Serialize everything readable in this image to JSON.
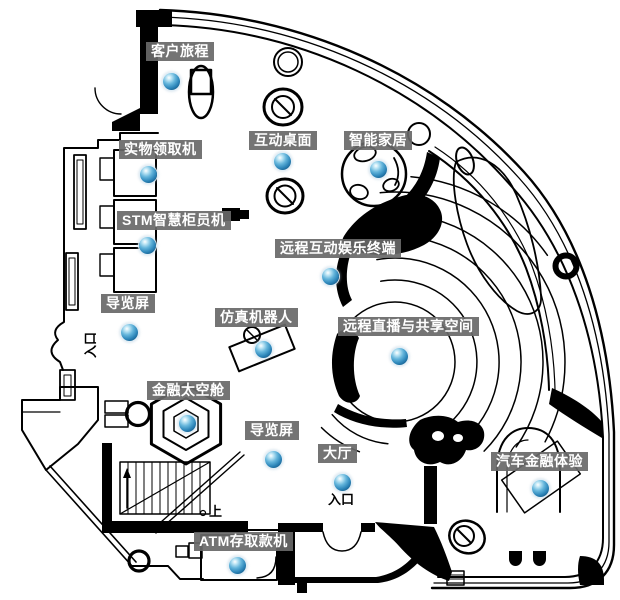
{
  "map": {
    "colors": {
      "background": "#ffffff",
      "wall": "#000000",
      "label_bg": "#686868",
      "label_text": "#ffffff",
      "hotspot_blue": "#2f88bb"
    },
    "pois": [
      {
        "id": "customer-journey",
        "label": "客户旅程",
        "label_x": 146,
        "label_y": 42,
        "dot_x": 171,
        "dot_y": 81
      },
      {
        "id": "physical-item-pickup-machine",
        "label": "实物领取机",
        "label_x": 119,
        "label_y": 140,
        "dot_x": 148,
        "dot_y": 174
      },
      {
        "id": "stm-smart-teller-machine",
        "label": "STM智慧柜员机",
        "label_x": 117,
        "label_y": 211,
        "dot_x": 147,
        "dot_y": 245
      },
      {
        "id": "guide-screen-north",
        "label": "导览屏",
        "label_x": 101,
        "label_y": 294,
        "dot_x": 129,
        "dot_y": 332
      },
      {
        "id": "interactive-table",
        "label": "互动桌面",
        "label_x": 249,
        "label_y": 131,
        "dot_x": 282,
        "dot_y": 161
      },
      {
        "id": "smart-home",
        "label": "智能家居",
        "label_x": 344,
        "label_y": 131,
        "dot_x": 378,
        "dot_y": 169
      },
      {
        "id": "remote-interactive-entertainment-terminal",
        "label": "远程互动娱乐终端",
        "label_x": 275,
        "label_y": 239,
        "dot_x": 330,
        "dot_y": 276
      },
      {
        "id": "simulation-robot",
        "label": "仿真机器人",
        "label_x": 215,
        "label_y": 308,
        "dot_x": 263,
        "dot_y": 349
      },
      {
        "id": "remote-live-shared-space",
        "label": "远程直播与共享空间",
        "label_x": 338,
        "label_y": 317,
        "dot_x": 399,
        "dot_y": 356
      },
      {
        "id": "finance-space-capsule",
        "label": "金融太空舱",
        "label_x": 147,
        "label_y": 381,
        "dot_x": 187,
        "dot_y": 423
      },
      {
        "id": "guide-screen-south",
        "label": "导览屏",
        "label_x": 245,
        "label_y": 421,
        "dot_x": 273,
        "dot_y": 459
      },
      {
        "id": "lobby",
        "label": "大厅",
        "label_x": 318,
        "label_y": 444,
        "dot_x": 342,
        "dot_y": 482
      },
      {
        "id": "auto-finance-experience",
        "label": "汽车金融体验",
        "label_x": 491,
        "label_y": 452,
        "dot_x": 540,
        "dot_y": 488
      },
      {
        "id": "atm-deposit-withdrawal",
        "label": "ATM存取款机",
        "label_x": 194,
        "label_y": 532,
        "dot_x": 237,
        "dot_y": 565
      }
    ],
    "annotations": [
      {
        "id": "stairs-up",
        "text": "上",
        "x": 209,
        "y": 505,
        "rotated": false
      },
      {
        "id": "main-entrance",
        "text": "入口",
        "x": 328,
        "y": 493,
        "rotated": false
      },
      {
        "id": "side-entrance",
        "text": "入口",
        "x": 84,
        "y": 358,
        "rotated": true
      }
    ]
  }
}
